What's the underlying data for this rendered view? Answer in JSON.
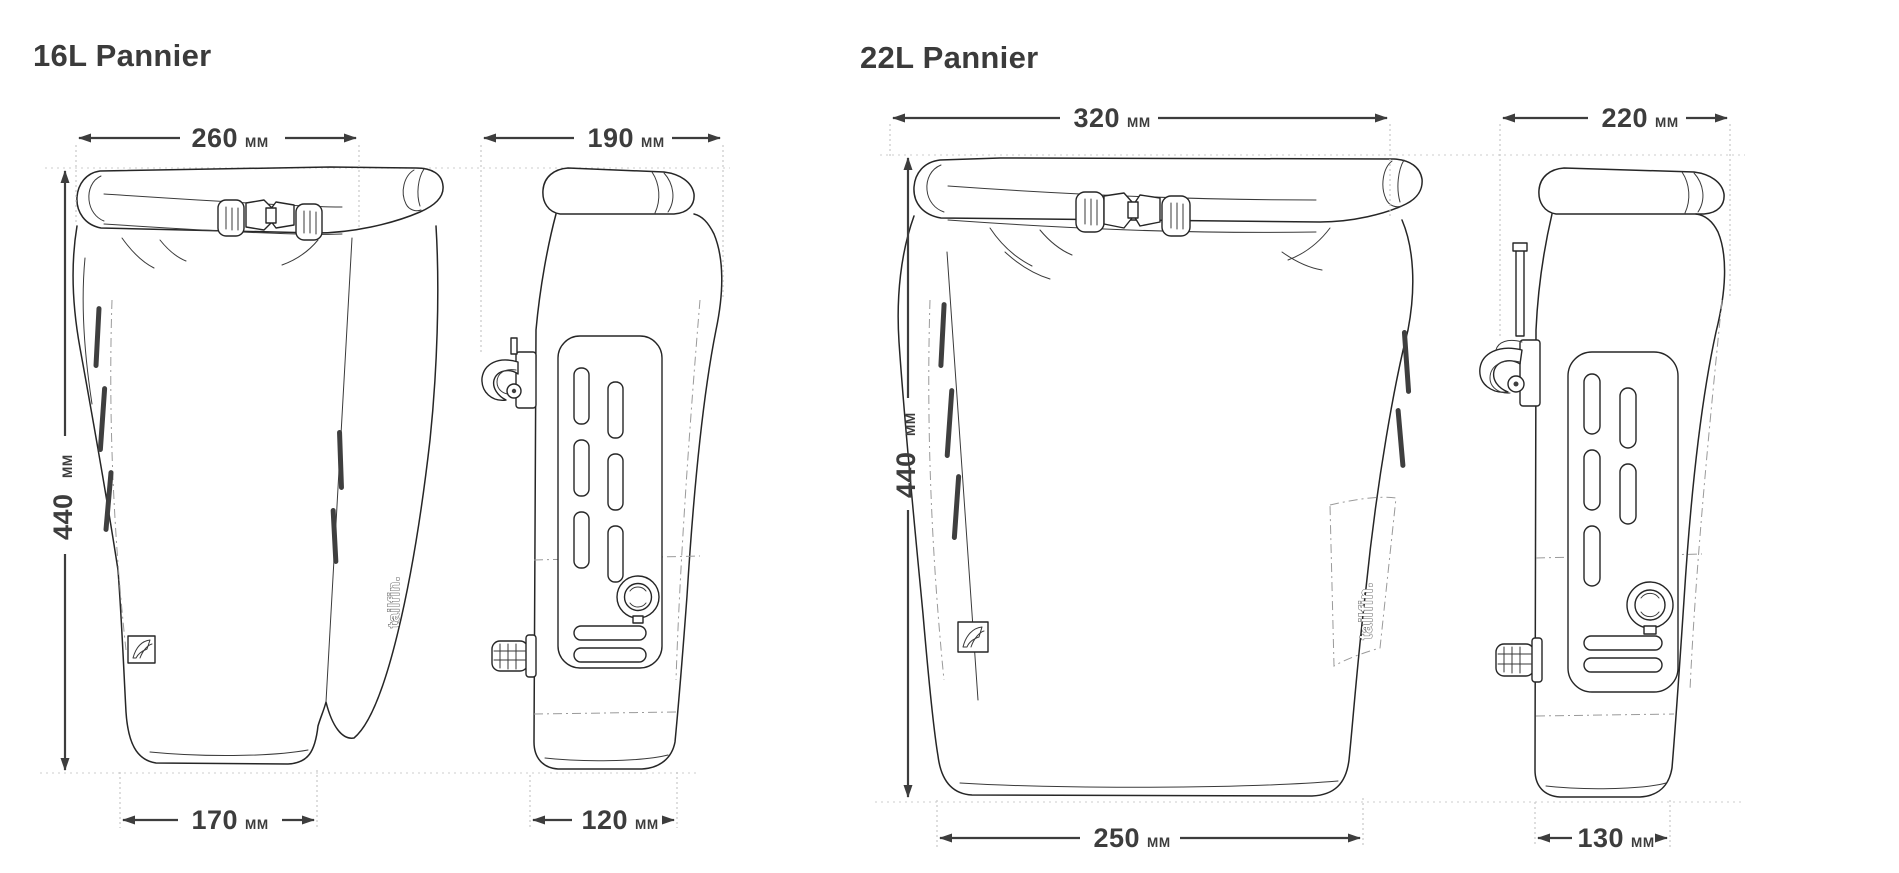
{
  "colors": {
    "background": "#ffffff",
    "drawing_line": "#262626",
    "dimension_line": "#3d3d3d",
    "text": "#3b3b3b",
    "guide_line": "#c9c9c9"
  },
  "panniers": [
    {
      "title": "16L Pannier",
      "logo": "tailfin.",
      "front": {
        "top_width": {
          "value": "260",
          "unit": "MM"
        },
        "height": {
          "value": "440",
          "unit": "MM"
        },
        "bottom_width": {
          "value": "170",
          "unit": "MM"
        }
      },
      "side": {
        "top_width": {
          "value": "190",
          "unit": "MM"
        },
        "bottom_width": {
          "value": "120",
          "unit": "MM"
        }
      }
    },
    {
      "title": "22L Pannier",
      "logo": "tailfin.",
      "front": {
        "top_width": {
          "value": "320",
          "unit": "MM"
        },
        "height": {
          "value": "440",
          "unit": "MM"
        },
        "bottom_width": {
          "value": "250",
          "unit": "MM"
        }
      },
      "side": {
        "top_width": {
          "value": "220",
          "unit": "MM"
        },
        "bottom_width": {
          "value": "130",
          "unit": "MM"
        }
      }
    }
  ]
}
